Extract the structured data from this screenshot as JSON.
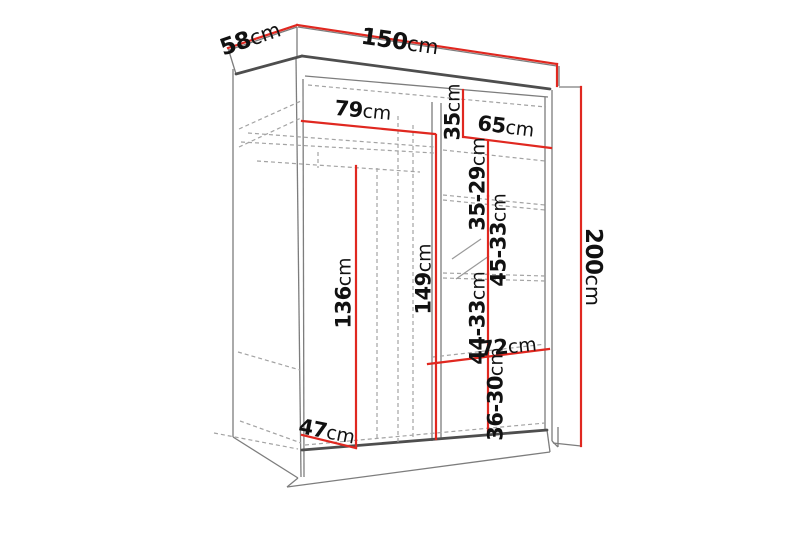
{
  "figure": {
    "type": "furniture-dimension-diagram",
    "subject": "sliding-door wardrobe shown in perspective with interior shelf measurements"
  },
  "colors": {
    "dimension_line": "#e02820",
    "outline": "#7d7d7d",
    "outline_heavy": "#4e4e4e",
    "dashed": "#a3a3a3",
    "label_text": "#111111",
    "background": "#ffffff"
  },
  "dims": {
    "width150": {
      "value": "150",
      "unit": "cm"
    },
    "depth58": {
      "value": "58",
      "unit": "cm"
    },
    "height200": {
      "value": "200",
      "unit": "cm"
    },
    "shelf79": {
      "value": "79",
      "unit": "cm"
    },
    "h35": {
      "value": "35",
      "unit": "cm"
    },
    "shelf65": {
      "value": "65",
      "unit": "cm"
    },
    "h3529": {
      "value": "35-29",
      "unit": "cm"
    },
    "h4533": {
      "value": "45-33",
      "unit": "cm"
    },
    "h149": {
      "value": "149",
      "unit": "cm"
    },
    "h136": {
      "value": "136",
      "unit": "cm"
    },
    "h4433": {
      "value": "44-33",
      "unit": "cm"
    },
    "w72": {
      "value": "72",
      "unit": "cm"
    },
    "h3630": {
      "value": "36-30",
      "unit": "cm"
    },
    "d47": {
      "value": "47",
      "unit": "cm"
    }
  }
}
